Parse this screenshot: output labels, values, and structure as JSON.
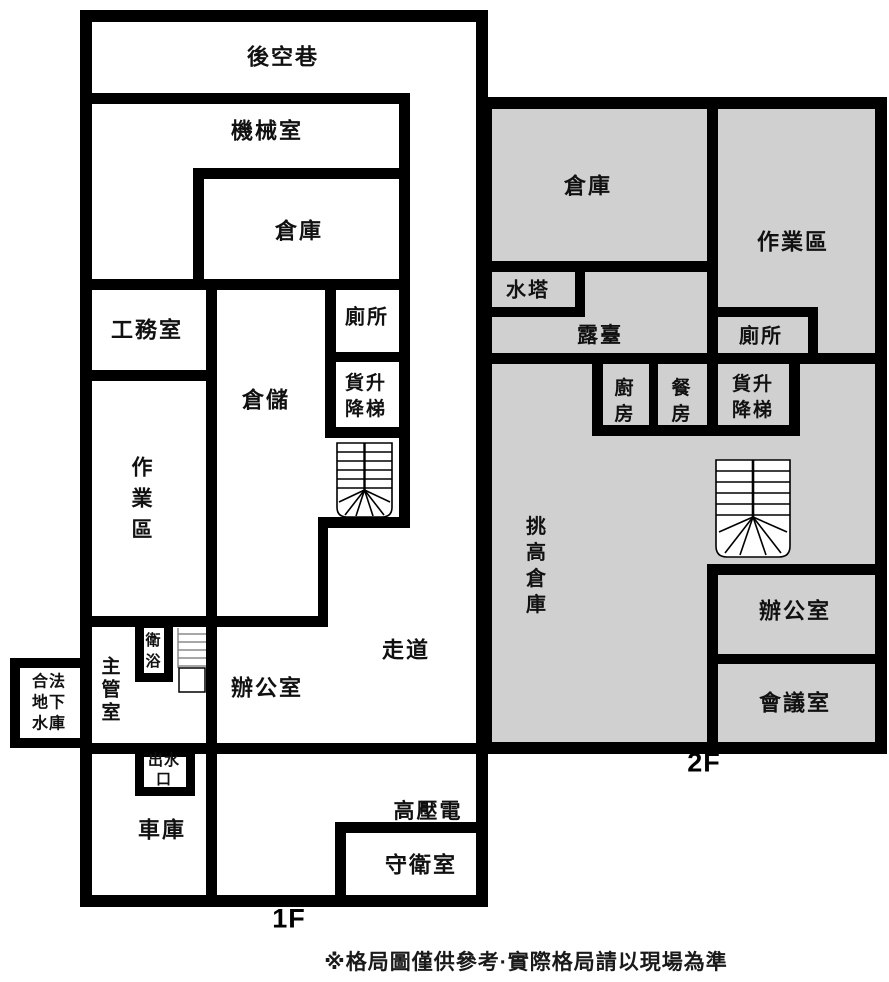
{
  "colors": {
    "wall": "#000000",
    "floor2_fill": "#d0d0d0",
    "background": "#ffffff"
  },
  "floor1": {
    "floor_label": "1F",
    "rooms": {
      "back_alley": "後空巷",
      "machine_room": "機械室",
      "warehouse": "倉庫",
      "engineering_office": "工務室",
      "toilet": "廁所",
      "storage": "倉儲",
      "freight_elevator": "貨升\n降梯",
      "work_area": "作\n業\n區",
      "bathroom": "衛\n浴",
      "supervisor_room": "主\n管\n室",
      "office": "辦公室",
      "corridor": "走道",
      "legal_underground_reservoir": "合法\n地下\n水庫",
      "water_outlet": "出水\n口",
      "garage": "車庫",
      "high_voltage": "高壓電",
      "guard_room": "守衛室"
    }
  },
  "floor2": {
    "floor_label": "2F",
    "rooms": {
      "warehouse": "倉庫",
      "work_area": "作業區",
      "water_tower": "水塔",
      "terrace": "露臺",
      "toilet": "廁所",
      "kitchen": "廚\n房",
      "dining_room": "餐\n房",
      "freight_elevator": "貨升\n降梯",
      "double_height_warehouse": "挑\n高\n倉\n庫",
      "office": "辦公室",
      "meeting_room": "會議室"
    }
  },
  "footer": {
    "disclaimer": "※格局圖僅供參考·實際格局請以現場為準"
  }
}
